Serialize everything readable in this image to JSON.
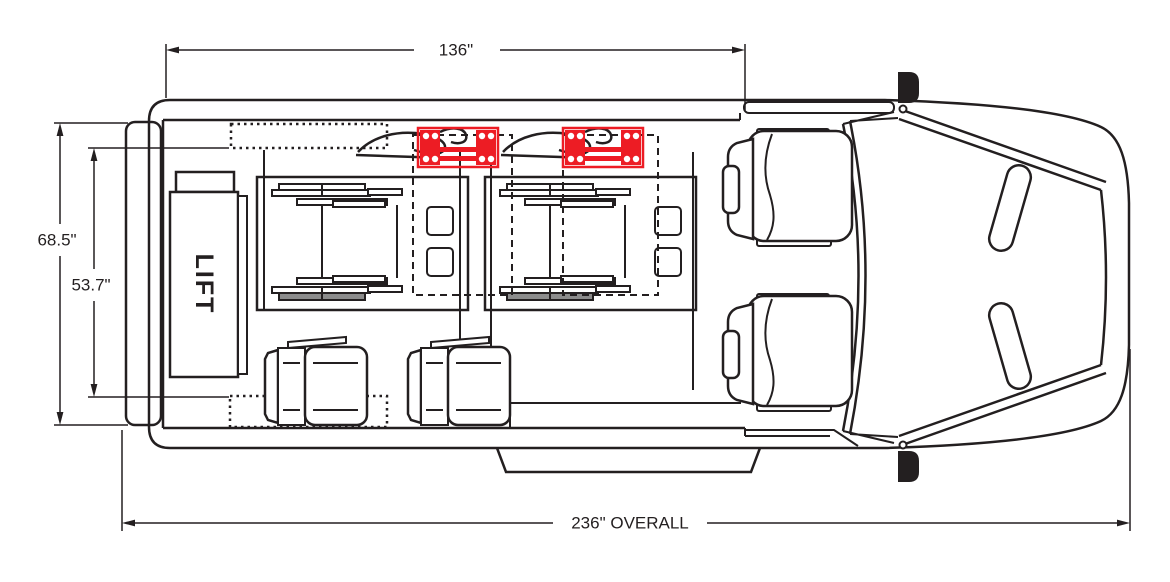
{
  "diagram": {
    "type": "vehicle-floor-plan-top-view",
    "labels": {
      "lift": "LIFT",
      "dim_interior_length": "136\"",
      "dim_body_width": "68.5\"",
      "dim_interior_width": "53.7\"",
      "dim_overall_length": "236\" OVERALL"
    },
    "colors": {
      "line": "#231f20",
      "restraint": "#ed1c24",
      "wheel_shade": "#8c8c8c",
      "background": "#ffffff"
    }
  }
}
